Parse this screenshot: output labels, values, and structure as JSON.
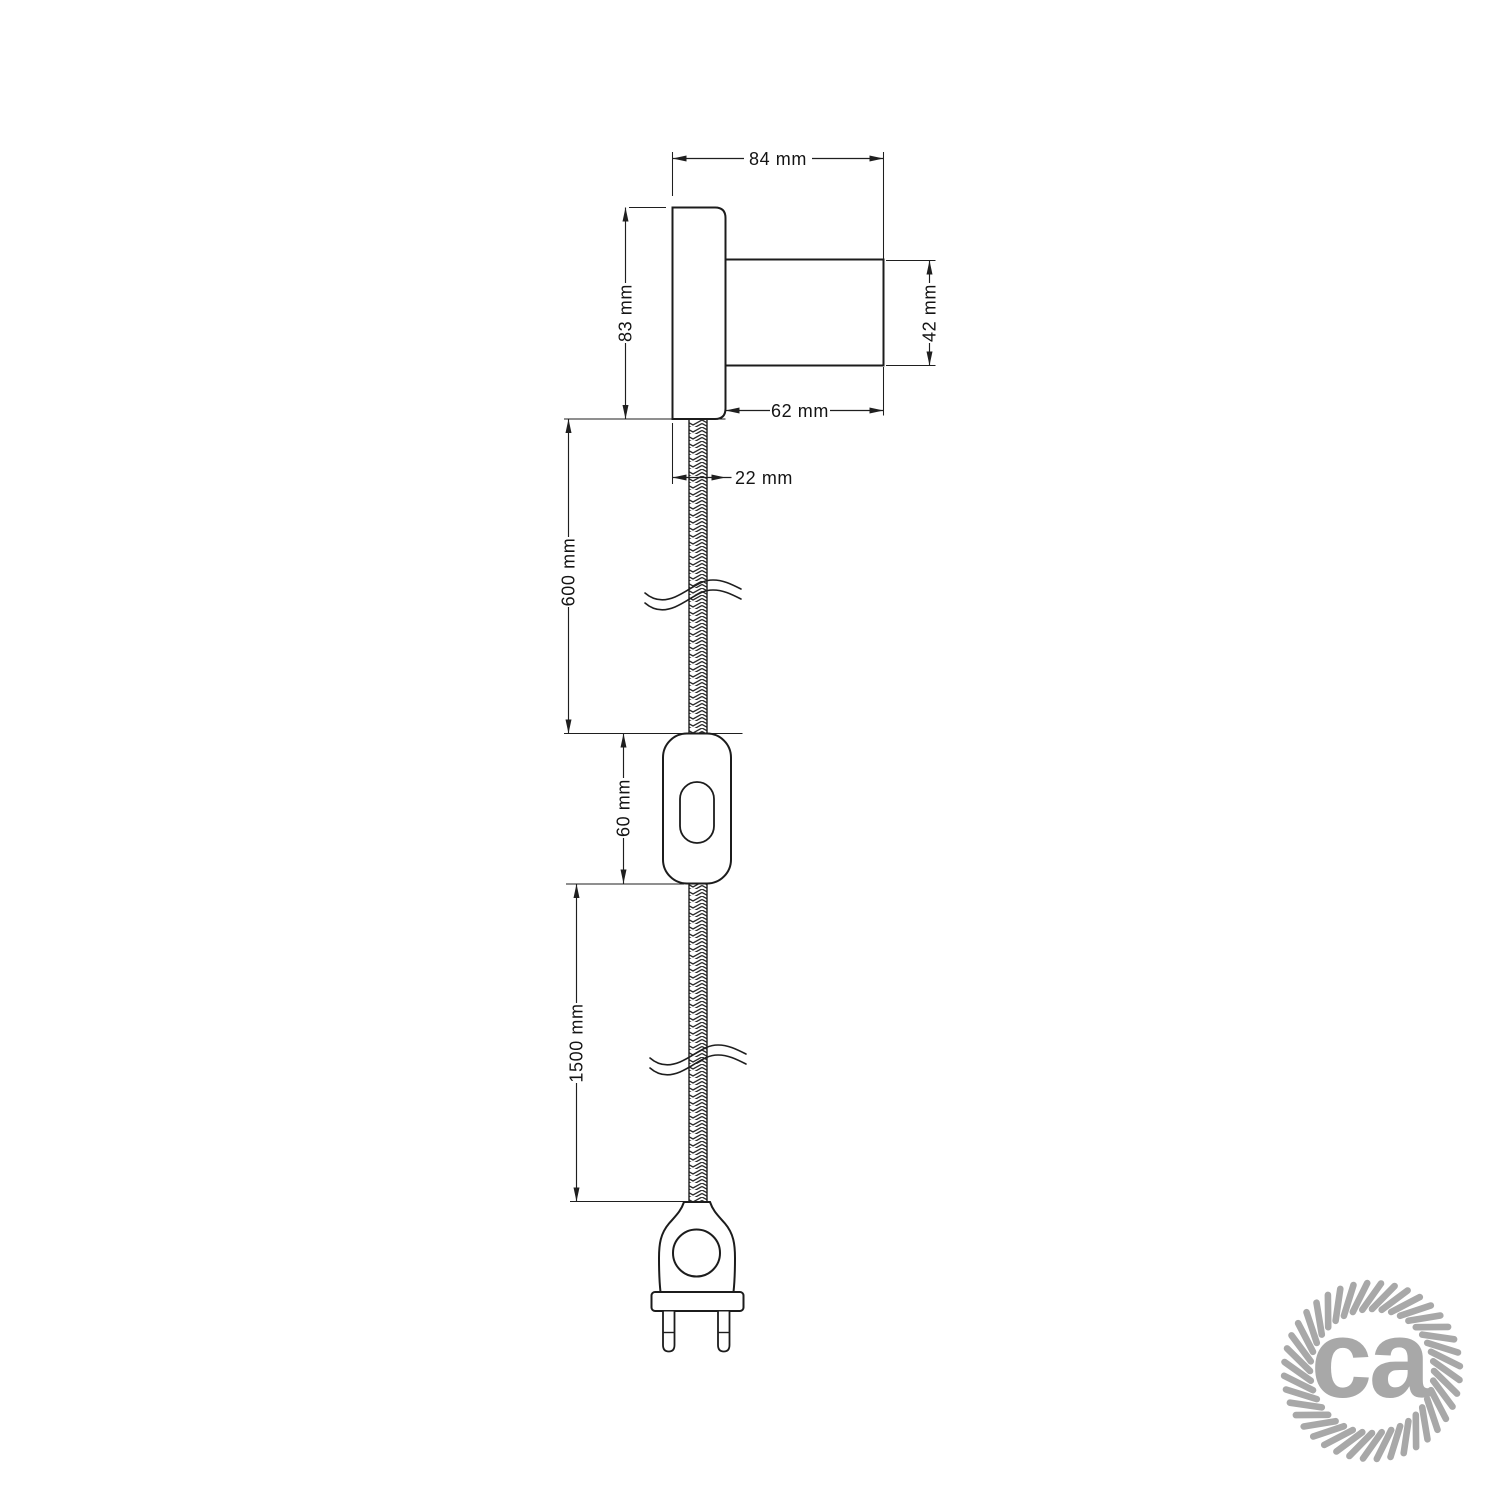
{
  "drawing": {
    "dims": {
      "overall_width": "84 mm",
      "plate_height": "83 mm",
      "holder_diameter": "42 mm",
      "holder_length": "62 mm",
      "plate_thickness": "22 mm",
      "upper_cable_length": "600 mm",
      "switch_length": "60 mm",
      "lower_cable_length": "1500 mm"
    },
    "logo": {
      "text": "ca",
      "color": "#a8a8a8"
    },
    "colors": {
      "line": "#1c1c1c",
      "background": "#ffffff"
    }
  }
}
